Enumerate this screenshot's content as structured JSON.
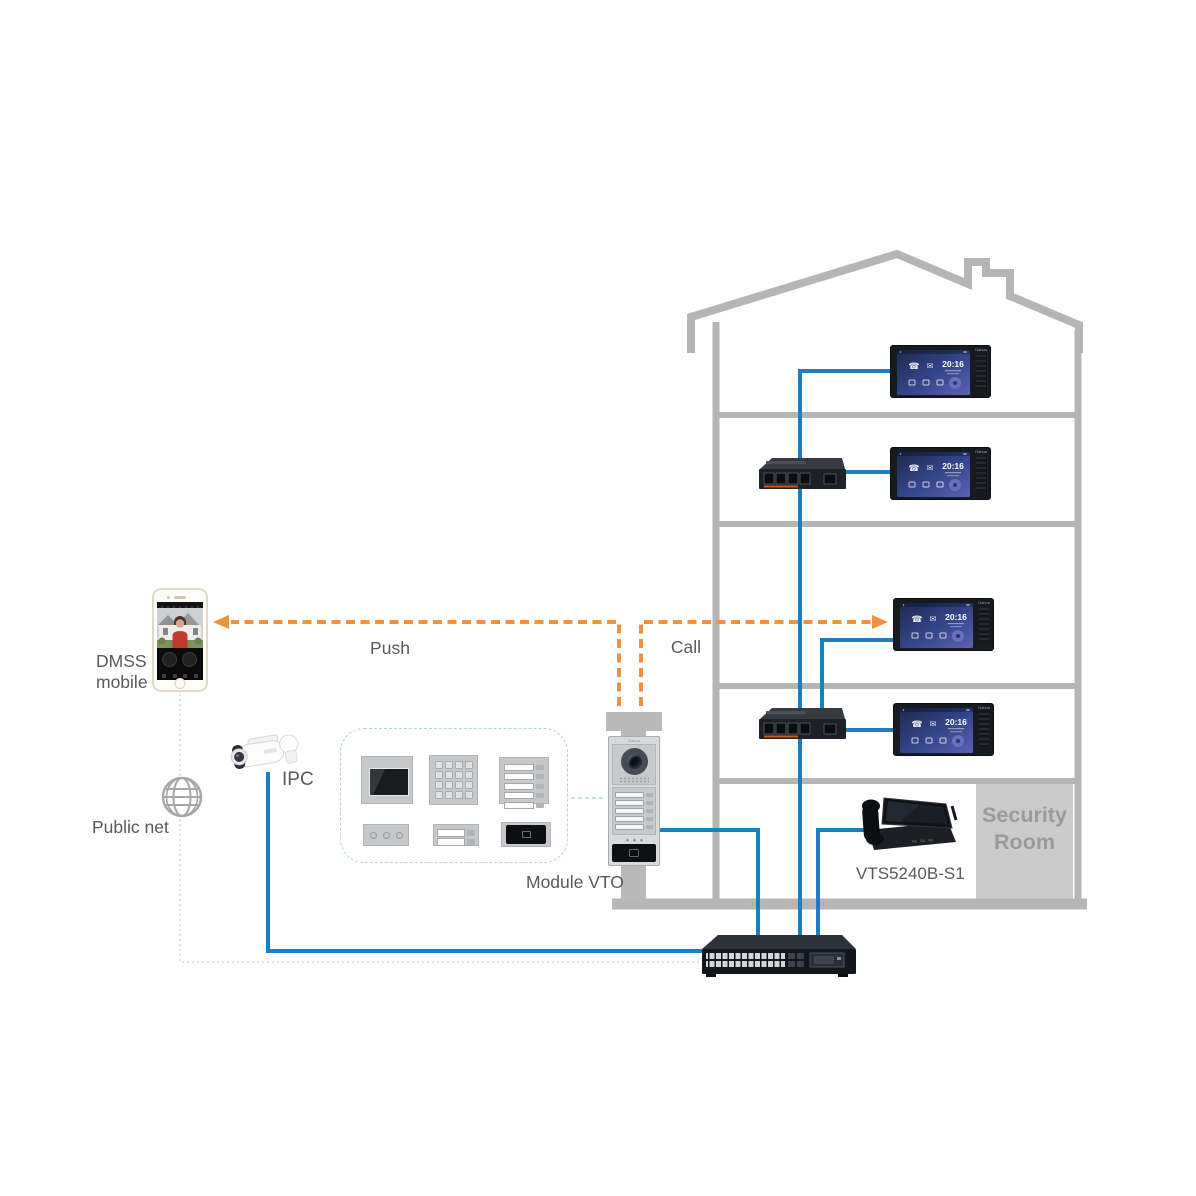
{
  "brand": "Dahua",
  "labels": {
    "push": "Push",
    "call": "Call",
    "ipc": "IPC",
    "dmss_line1": "DMSS",
    "dmss_line2": "mobile",
    "public_net": "Public net",
    "module_vto": "Module VTO",
    "vts_model": "VTS5240B-S1",
    "security_line1": "Security",
    "security_line2": "Room"
  },
  "monitor": {
    "time": "20:16"
  },
  "colors": {
    "line_blue": "#1b7ec2",
    "arrow_orange": "#ef913d",
    "building_gray": "#b5b5b5",
    "security_room_fill": "#cbcbcb",
    "security_room_text": "#9a9a9a",
    "label_text": "#595959",
    "module_box_border": "#a9d4e4"
  }
}
